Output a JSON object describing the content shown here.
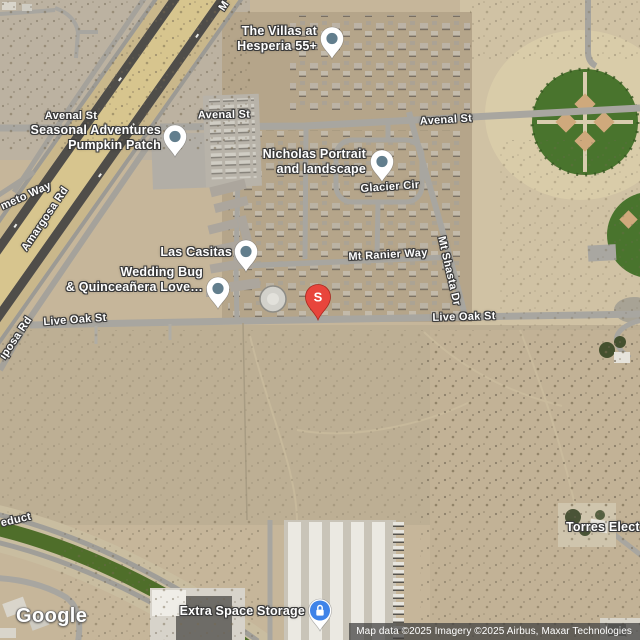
{
  "map": {
    "logo": "Google",
    "attribution": "Map data ©2025 Imagery ©2025 Airbus, Maxar Technologies",
    "marker_letter": "S"
  },
  "streets": {
    "avenal_left": "Avenal St",
    "avenal_center": "Avenal St",
    "avenal_right": "Avenal St",
    "glacier_cir": "Glacier Cir",
    "mt_ranier_way": "Mt Ranier Way",
    "mt_shasta_dr": "Mt Shasta Dr",
    "live_oak_left": "Live Oak St",
    "live_oak_right": "Live Oak St",
    "amargosa_rd": "Amargosa Rd",
    "mariposa_rd_partial": "iposa Rd",
    "mariposa_top_partial": "M",
    "meto_way_partial": "meto Way",
    "aqueduct_partial": "educt"
  },
  "places": {
    "villas": {
      "line1": "The Villas at",
      "line2": "Hesperia 55+"
    },
    "pumpkin_patch": {
      "line1": "Seasonal Adventures",
      "line2": "Pumpkin Patch"
    },
    "nicholas": {
      "line1": "Nicholas Portrait",
      "line2": "and landscape"
    },
    "las_casitas": {
      "line1": "Las Casitas"
    },
    "wedding_bug": {
      "line1": "Wedding Bug",
      "line2": "& Quinceañera Love…"
    },
    "extra_space": {
      "line1": "Extra Space Storage"
    },
    "torres": {
      "line1": "Torres Elect"
    }
  },
  "colors": {
    "marker_red": "#e8453c",
    "storage_pin_blue": "#3f83e8",
    "poi_pin_dot": "#627e8d",
    "park_green": "#49742d",
    "aqueduct_green": "#4f6e2a",
    "label_text": "#ffffff",
    "attribution_bg": "rgba(62,62,62,0.72)"
  }
}
